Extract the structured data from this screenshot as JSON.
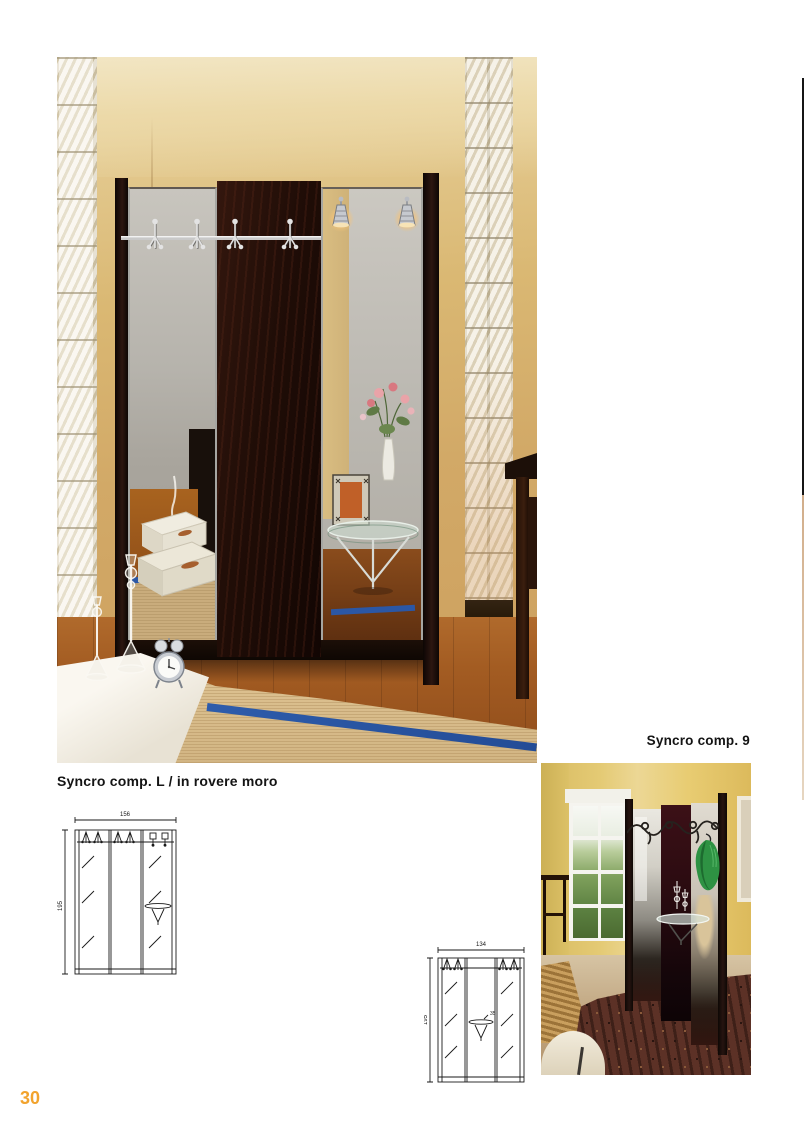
{
  "page": {
    "number": "30",
    "accent_color": "#f2a32d"
  },
  "captions": {
    "comp_l": "Syncro comp. L / in rovere moro",
    "comp_9": "Syncro comp. 9"
  },
  "diagrams": {
    "comp_l": {
      "width": "156",
      "height": "195"
    },
    "comp_9": {
      "width": "134",
      "height": "195",
      "shelf_depth": "35"
    }
  }
}
